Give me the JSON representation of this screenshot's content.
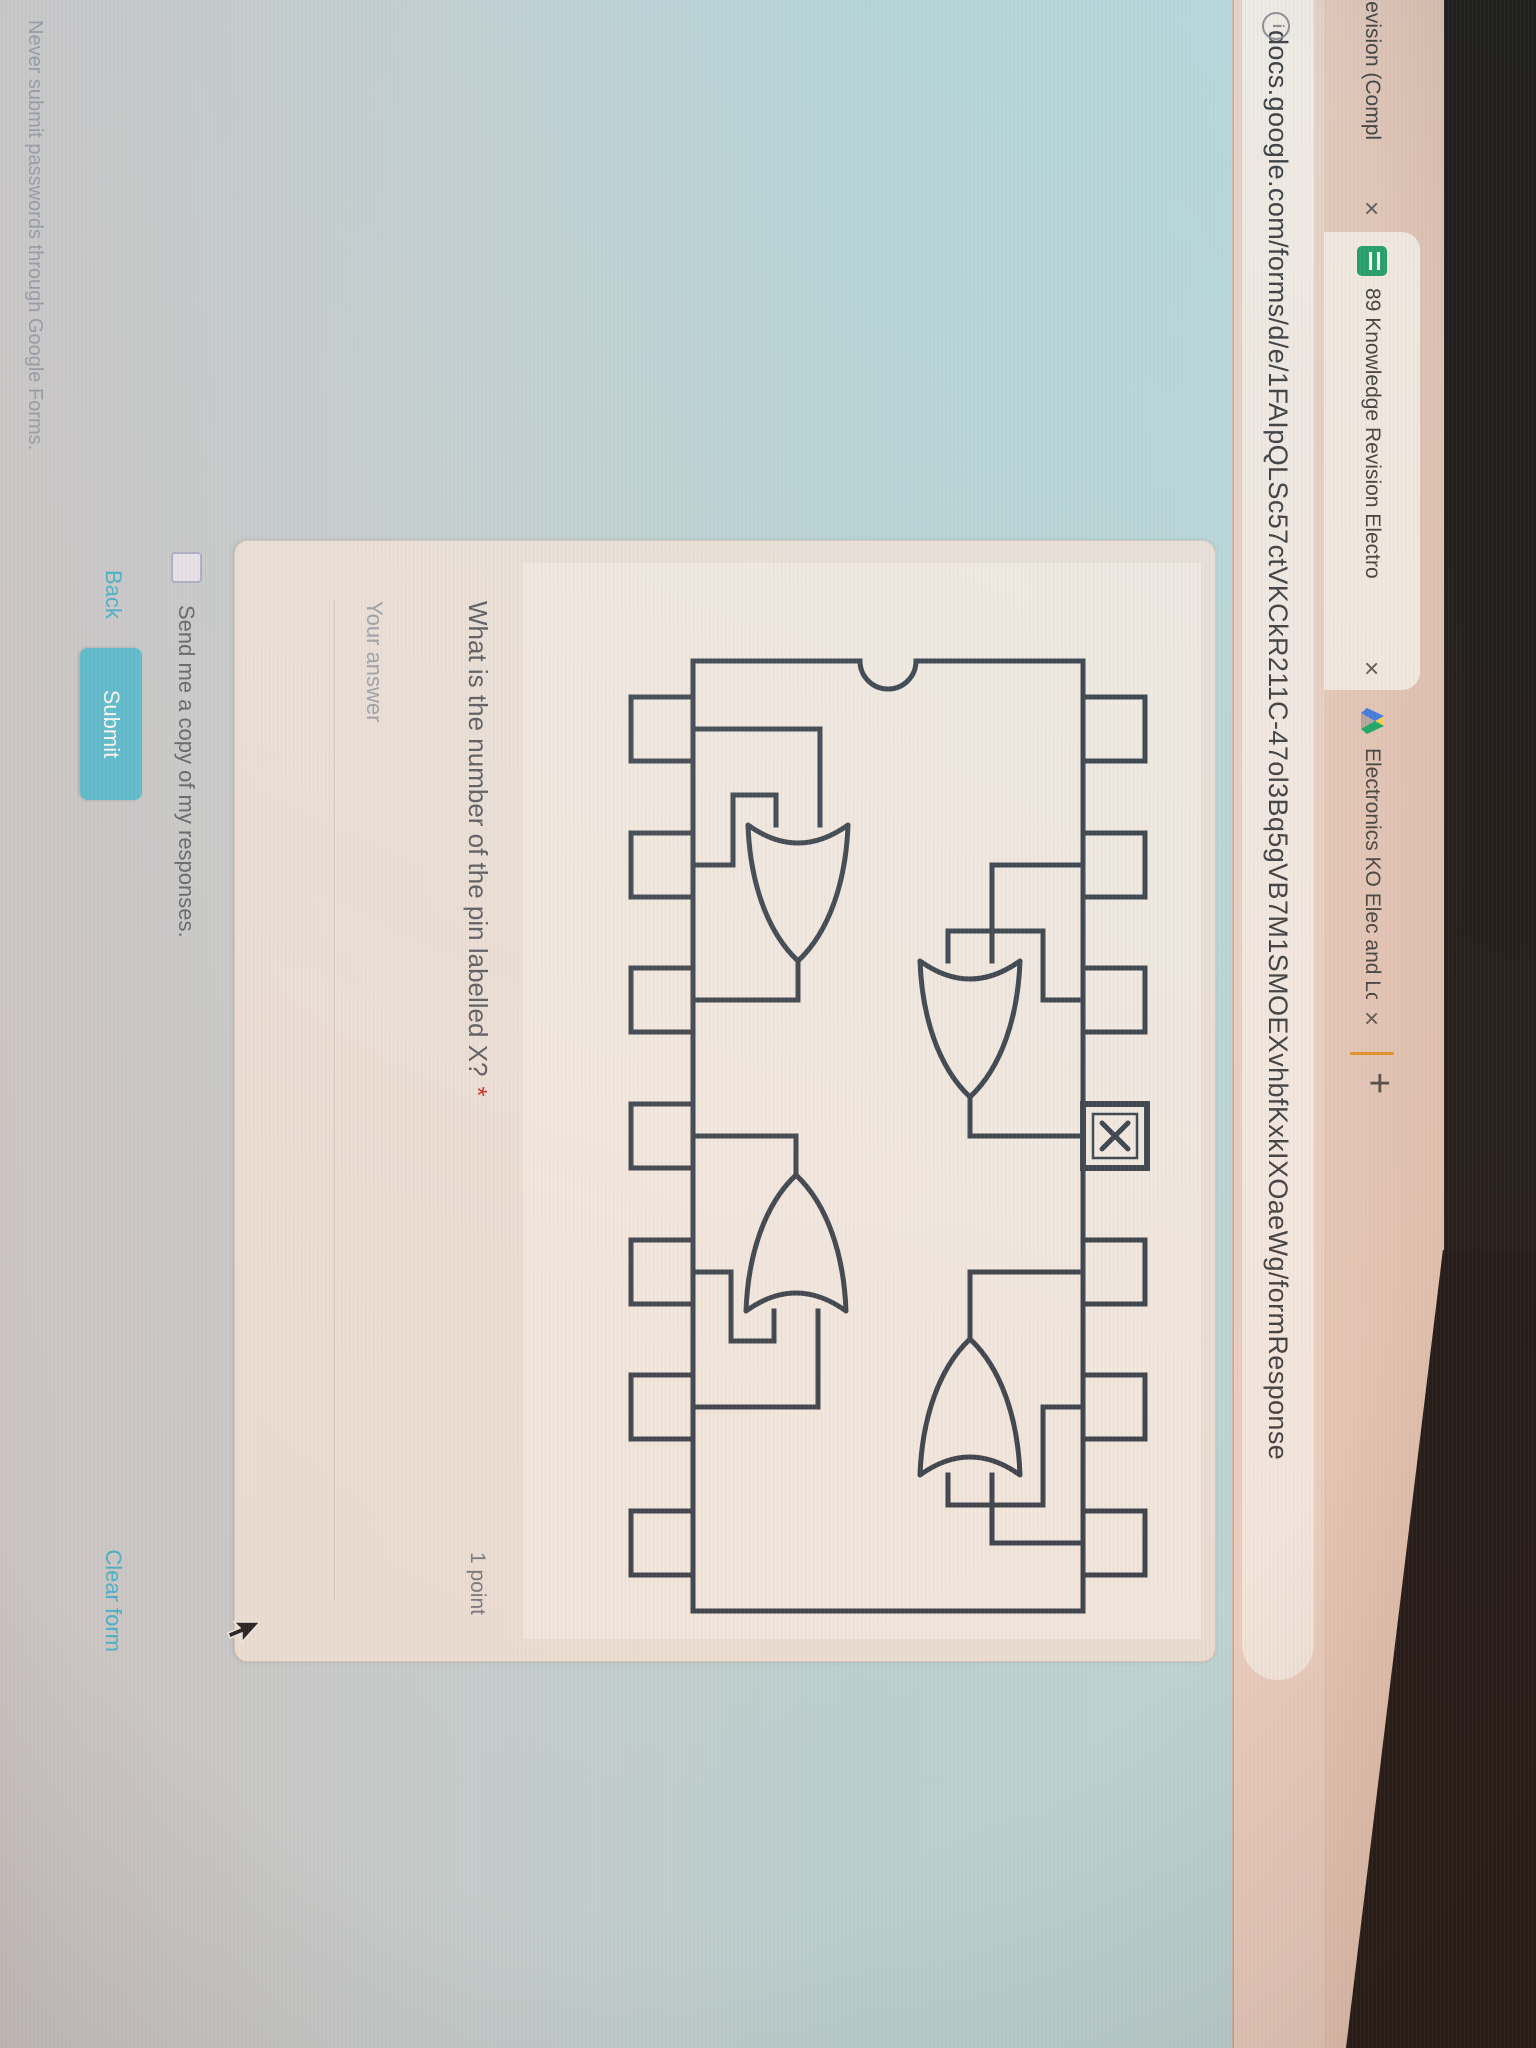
{
  "browser": {
    "tabs": [
      {
        "label": "Revision (Compl",
        "active": false
      },
      {
        "label": "89 Knowledge Revision Electro",
        "active": true
      },
      {
        "label": "Electronics KO Elec and Logic.p",
        "active": false
      }
    ],
    "close_label": "×",
    "new_tab_label": "+",
    "url": "docs.google.com/forms/d/e/1FAIpQLSc57ctVKCkR211C-47ol3Bq5gVB7M1SMOEXvhbfKxkIXOaeWg/formResponse",
    "info_icon_glyph": "i"
  },
  "form": {
    "question": {
      "title": "What is the number of the pin labelled X?",
      "required_marker": "*",
      "points": "1 point",
      "answer_placeholder": "Your answer",
      "image_label": "X"
    },
    "diagram": {
      "type": "ic-pinout",
      "package": "14-pin DIP, notch at left",
      "pins_per_side": 7,
      "gates": "4 two-input OR gates",
      "labelled_pin": "X on 4th pin of top row"
    },
    "options": {
      "send_copy_label": "Send me a copy of my responses."
    },
    "actions": {
      "back": "Back",
      "submit": "Submit",
      "clear": "Clear form"
    },
    "footer": "Never submit passwords through Google Forms."
  },
  "colors": {
    "accent_teal": "#3ab2cc",
    "submit_bg": "#52bdd4",
    "page_bg": "#bdd4da",
    "tabstrip_bg": "#e8cabb",
    "card_bg": "#ece4dd",
    "diagram_line": "#2c3947",
    "required_red": "#c5221f"
  }
}
